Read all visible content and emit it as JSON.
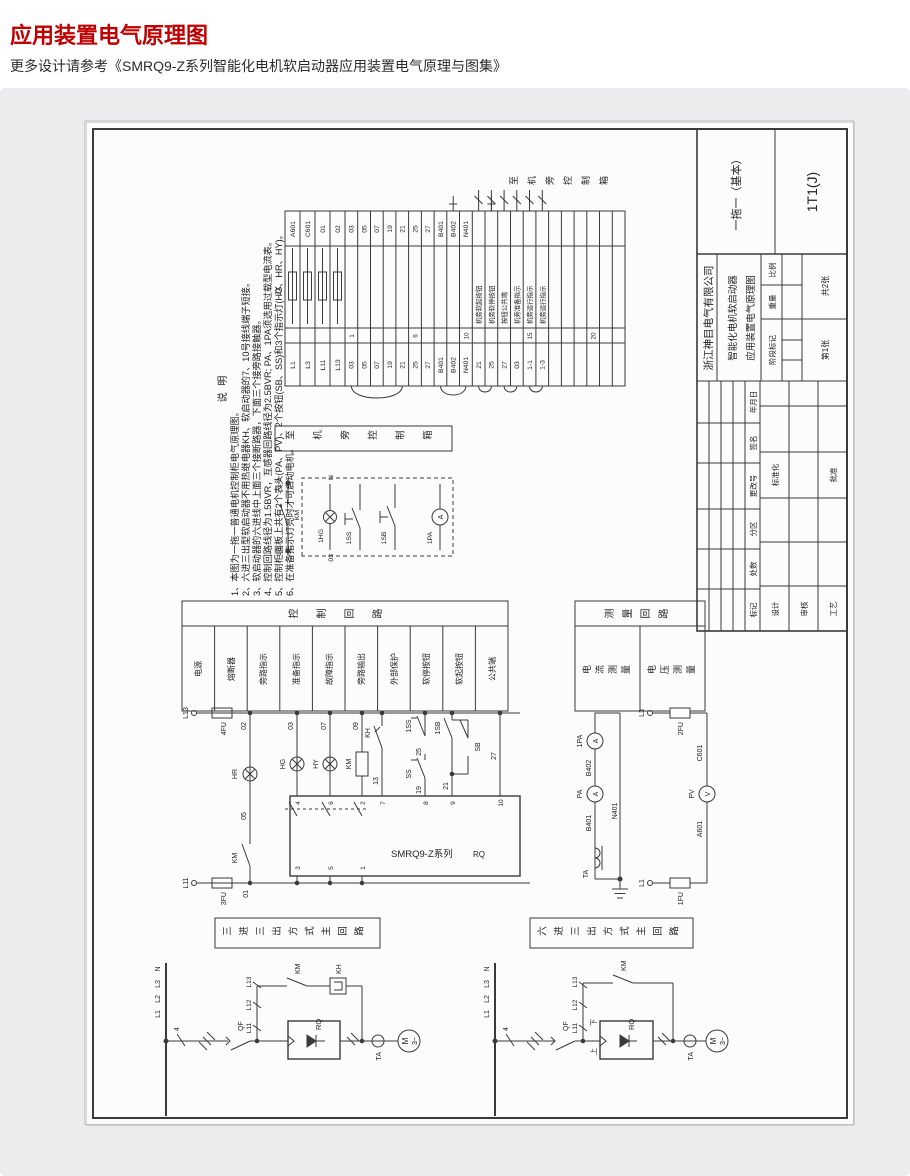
{
  "page": {
    "title": "应用装置电气原理图",
    "subtitle": "更多设计请参考《SMRQ9-Z系列智能化电机软启动器应用装置电气原理与图集》"
  },
  "titleblock": {
    "company": "浙江神目电气有限公司",
    "product": "智能化电机软启动器",
    "drawing_title": "应用装置电气原理图",
    "variant": "一拖一（基本）",
    "code": "1T1(J)",
    "total": "共2张",
    "sheet": "第1张",
    "scale": "比例",
    "weight": "重量",
    "stage": "阶段标记",
    "mark": "标记",
    "count": "处数",
    "zone": "分区",
    "change": "更改号",
    "sign": "签名",
    "date": "年月日",
    "design": "设计",
    "standard": "标准化",
    "audit": "审核",
    "craft": "工艺",
    "approve": "批准"
  },
  "notes": {
    "heading": "说    明",
    "items": [
      "1、本图为一拖一普通电机控制柜电气原理图。",
      "2、六进三出型软启动器不用热继电器KH、软启动器的7、10号接线端子短接。",
      "3、软启动器的六进线中上面三个接断路器，下面三个接旁路接触器。",
      "4、控制回路线径为1.5BVR，互感器回路线径为2.5BVR; PA、1PA须选用过载型电流表。",
      "5、控制柜面板上共有2个表头(PA、PV)、2个按钮(SB、SS)和3个指示灯(HG、HR、HY)。",
      "6、在准备指示灯亮时才可启动电机。"
    ]
  },
  "strip": {
    "jx": "JX",
    "to_box": "至机旁控制箱",
    "power": [
      {
        "o": "L1",
        "i": "A601"
      },
      {
        "o": "L3",
        "i": "C601"
      },
      {
        "o": "L11",
        "i": "01"
      },
      {
        "o": "L13",
        "i": "02"
      }
    ],
    "slots": [
      {
        "o": "03",
        "i": "03",
        "n": "1"
      },
      {
        "o": "05",
        "i": "05"
      },
      {
        "o": "07",
        "i": "07"
      },
      {
        "o": "19",
        "i": "19"
      },
      {
        "o": "21",
        "i": "21"
      },
      {
        "o": "25",
        "i": "25",
        "n": "6"
      },
      {
        "o": "27",
        "i": "27"
      },
      {
        "o": "B401",
        "i": "B401"
      },
      {
        "o": "B402",
        "i": "B402"
      },
      {
        "o": "N401",
        "i": "N401",
        "n": "10"
      },
      {
        "o": "21",
        "f": "机旁软起按钮"
      },
      {
        "o": "25",
        "f": "机旁软停按钮"
      },
      {
        "o": "27",
        "f": "按钮公共端"
      },
      {
        "o": "03",
        "f": "机旁准备指示"
      },
      {
        "o": "1-1",
        "f": "机旁运行指示",
        "n": "15"
      },
      {
        "o": "1-3",
        "f": "机旁运行指示"
      },
      {
        "n": "20"
      }
    ]
  },
  "remote": {
    "label": "至机旁控制箱",
    "km": "KM",
    "t11": "1-1",
    "t13": "1-3",
    "hg": "1HG",
    "w03": "03",
    "n": "N",
    "ss": "1SS",
    "sb": "1SB",
    "pa": "1PA",
    "a": "A"
  },
  "ctrl_table": {
    "header": "控制回路",
    "rows": [
      "电源",
      "熔断器",
      "旁路指示",
      "准备指示",
      "故障指示",
      "旁路输出",
      "外部保护",
      "软停按钮",
      "软起按钮",
      "公共端"
    ]
  },
  "meas_table": {
    "header": "测量回路",
    "rows": [
      "电流测量",
      "电压测量"
    ]
  },
  "ctrl": {
    "l13": "L13",
    "fu4": "4FU",
    "l11": "L11",
    "fu3": "3FU",
    "w01": "01",
    "w02": "02",
    "hr": "HR",
    "w05": "05",
    "km": "KM",
    "w03": "03",
    "hg": "HG",
    "w07": "07",
    "hy": "HY",
    "w09": "09",
    "kmc": "KM",
    "kh": "KH",
    "w13": "13",
    "ss1": "1SS",
    "w25": "25",
    "ss": "SS",
    "w19": "19",
    "sb1": "1SB",
    "sb": "SB",
    "w21": "21",
    "w27": "27",
    "box": "SMRQ9-Z系列",
    "rq": "RQ",
    "t": [
      "4",
      "6",
      "2",
      "7",
      "8",
      "9",
      "10"
    ],
    "b": [
      "3",
      "5",
      "1"
    ]
  },
  "meas": {
    "ta": "TA",
    "b401": "B401",
    "pa": "PA",
    "b402": "B402",
    "pa1": "1PA",
    "n401": "N401",
    "l3": "L3",
    "fu2": "2FU",
    "c601": "C601",
    "pv": "PV",
    "a601": "A601",
    "fu1": "1FU",
    "l1": "L1",
    "a": "A",
    "v": "V"
  },
  "mainA": {
    "caption": "三进三出方式主回路",
    "w4": "4",
    "l1": "L1",
    "l2": "L2",
    "l3": "L3",
    "n": "N",
    "qf": "QF",
    "l11": "L11",
    "l12": "L12",
    "l13": "L13",
    "km": "KM",
    "kh": "KH",
    "rq": "RQ",
    "ta": "TA",
    "m": "M",
    "ph": "3~"
  },
  "mainB": {
    "caption": "六进三出方式主回路",
    "w4": "4",
    "l1": "L1",
    "l2": "L2",
    "l3": "L3",
    "n": "N",
    "qf": "QF",
    "l11": "L11",
    "l12": "L12",
    "l13": "L13",
    "km": "KM",
    "up": "上",
    "down": "下",
    "rq": "RQ",
    "ta": "TA",
    "m": "M",
    "ph": "3~"
  }
}
